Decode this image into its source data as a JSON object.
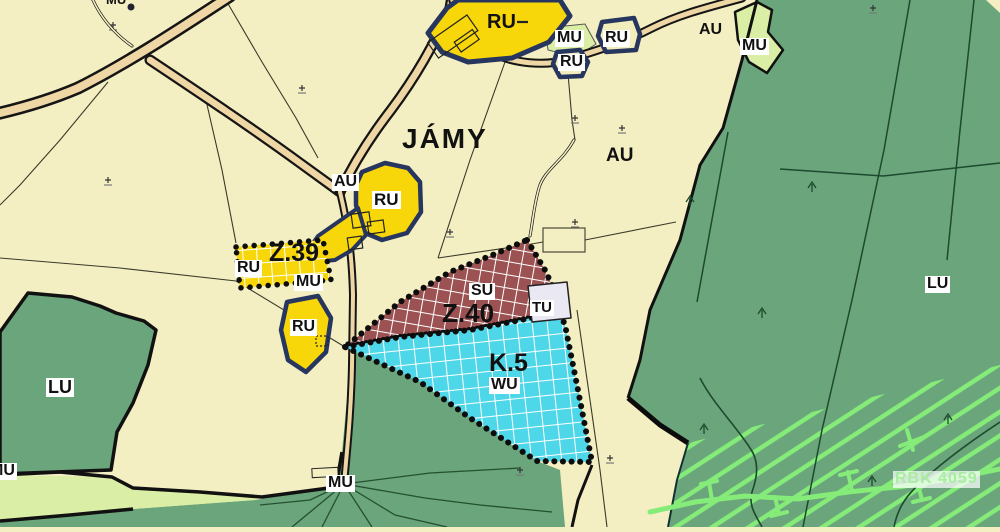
{
  "map": {
    "place_name": "JÁMY",
    "zone_ids": [
      "Z.39",
      "Z.40",
      "K.5",
      "RBK 4059"
    ],
    "area_codes": [
      "RU",
      "MU",
      "AU",
      "LU",
      "SU",
      "TU",
      "WU"
    ],
    "colors": {
      "background_cream": "#f4efc2",
      "forest_green": "#6aa57b",
      "pale_green": "#daeea6",
      "built_up_yellow": "#f7d60a",
      "outline_navy": "#26365e",
      "zone_maroon": "#9c5252",
      "zone_cyan": "#4ed7e9",
      "road_tan": "#eed7a4",
      "hatch_bright_green": "#85ec79",
      "rbk_label_green": "#a9eda2",
      "tu_grey": "#eae8f3"
    },
    "labels": [
      {
        "text": "JÁMY",
        "x": 400,
        "y": 124,
        "fs": 28,
        "bg": "none",
        "ls": 2
      },
      {
        "text": "RU",
        "x": 485,
        "y": 12,
        "fs": 20,
        "bg": "none"
      },
      {
        "text": "MU",
        "x": 555,
        "y": 30,
        "fs": 16,
        "bg": "#ffffff"
      },
      {
        "text": "RU",
        "x": 603,
        "y": 30,
        "fs": 16,
        "bg": "#ffffff"
      },
      {
        "text": "RU",
        "x": 558,
        "y": 54,
        "fs": 16,
        "bg": "#ffffff"
      },
      {
        "text": "AU",
        "x": 697,
        "y": 22,
        "fs": 16,
        "bg": "none"
      },
      {
        "text": "MU",
        "x": 740,
        "y": 38,
        "fs": 16,
        "bg": "#ffffff"
      },
      {
        "text": "AU",
        "x": 604,
        "y": 146,
        "fs": 19,
        "bg": "none"
      },
      {
        "text": "AU",
        "x": 332,
        "y": 174,
        "fs": 16,
        "bg": "#ffffff"
      },
      {
        "text": "RU",
        "x": 372,
        "y": 191,
        "fs": 17,
        "bg": "#ffffff"
      },
      {
        "text": "Z.39",
        "x": 267,
        "y": 240,
        "fs": 25,
        "bg": "none"
      },
      {
        "text": "RU",
        "x": 235,
        "y": 260,
        "fs": 16,
        "bg": "#ffffff"
      },
      {
        "text": "MU",
        "x": 294,
        "y": 274,
        "fs": 16,
        "bg": "#ffffff"
      },
      {
        "text": "RU",
        "x": 290,
        "y": 319,
        "fs": 16,
        "bg": "#ffffff"
      },
      {
        "text": "SU",
        "x": 469,
        "y": 283,
        "fs": 16,
        "bg": "#ffffff"
      },
      {
        "text": "Z.40",
        "x": 440,
        "y": 300,
        "fs": 26,
        "bg": "none"
      },
      {
        "text": "TU",
        "x": 530,
        "y": 300,
        "fs": 15,
        "bg": "#ffffff"
      },
      {
        "text": "K.5",
        "x": 487,
        "y": 350,
        "fs": 25,
        "bg": "none"
      },
      {
        "text": "WU",
        "x": 489,
        "y": 377,
        "fs": 16,
        "bg": "#ffffff"
      },
      {
        "text": "LU",
        "x": 46,
        "y": 378,
        "fs": 18,
        "bg": "#ffffff"
      },
      {
        "text": "LU",
        "x": 925,
        "y": 276,
        "fs": 16,
        "bg": "#ffffff"
      },
      {
        "text": "MU",
        "x": 326,
        "y": 475,
        "fs": 16,
        "bg": "#ffffff"
      },
      {
        "text": "MU",
        "x": -12,
        "y": 463,
        "fs": 16,
        "bg": "#ffffff"
      },
      {
        "text": "MU",
        "x": 104,
        "y": -7,
        "fs": 13,
        "bg": "none"
      },
      {
        "text": "RBK 4059",
        "x": 893,
        "y": 471,
        "fs": 16,
        "bg": "rgba(255,255,255,0.72)",
        "color": "#a9eda2",
        "ls": 1
      }
    ]
  }
}
